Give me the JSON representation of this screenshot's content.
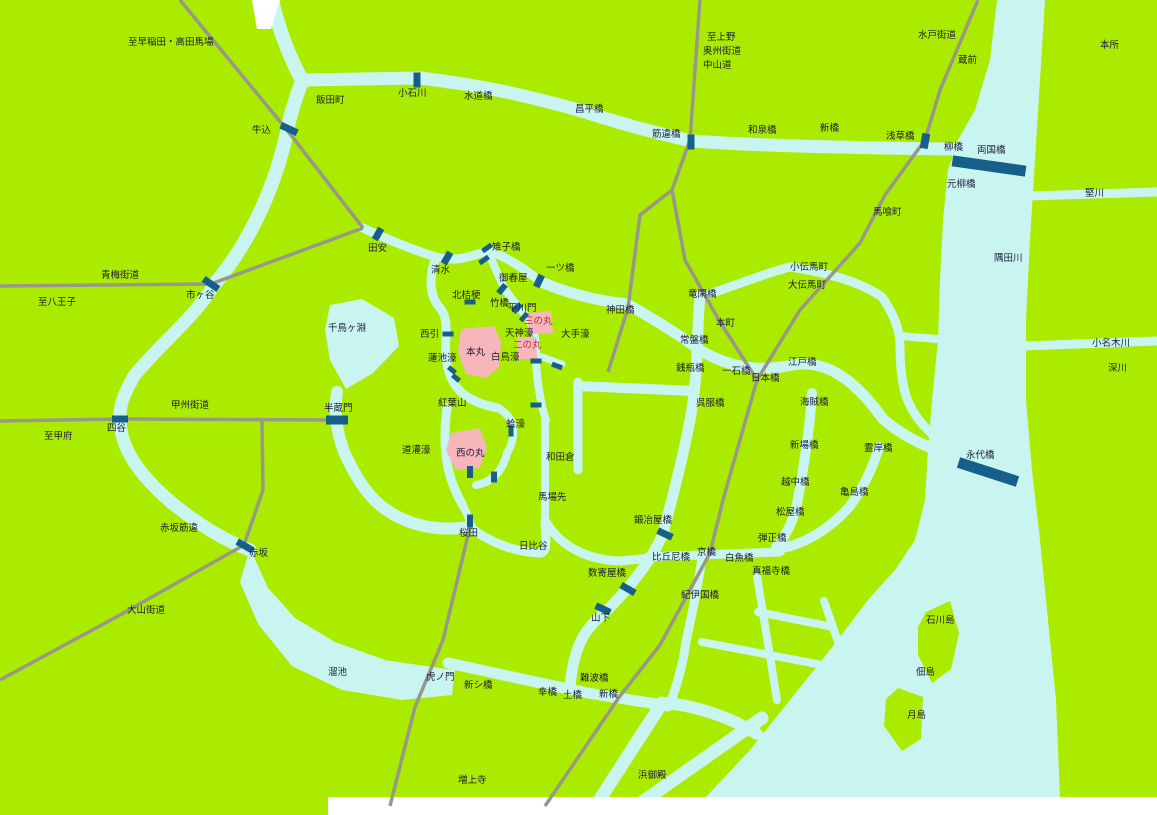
{
  "map": {
    "title": "江戸図 (Map of Edo)",
    "colors": {
      "land": "#abeb00",
      "water": "#c9f5f0",
      "bridge": "#155f8a",
      "road": "#98988a",
      "castle": "#f6b6bc",
      "label": "#1c1c3a",
      "castle_label": "#b03030",
      "edge": "#ffffff"
    },
    "water": {
      "polys": [
        {
          "name": "sumida-river-and-bay",
          "points": "997,0 990,60 975,110 958,140 948,170 943,220 940,280 938,340 932,400 928,450 925,500 915,540 895,570 868,600 830,650 790,700 750,750 706,797 1060,797 1056,700 1048,620 1040,540 1032,470 1026,400 1026,320 1030,240 1035,160 1040,80 1045,0"
        },
        {
          "name": "tameike-pond",
          "points": "250,548 268,588 295,618 335,642 385,660 432,667 455,670 452,695 402,700 342,690 292,666 258,624 240,582"
        },
        {
          "name": "chidorigafuchi-moat",
          "points": "330,305 362,299 394,318 399,346 373,373 346,389 330,360 325,330"
        }
      ],
      "paths": [
        {
          "name": "kanda-river-feeder",
          "d": "M272,0 C280,35 292,62 303,82",
          "w": 14
        },
        {
          "name": "kanda-river",
          "d": "M303,80 L420,78 C480,85 530,96 585,112 C635,128 662,134 691,141 C760,146 860,148 957,149",
          "w": 13
        },
        {
          "name": "ushigome-moat",
          "d": "M300,86 C291,112 288,124 287,132 C272,200 242,252 213,286",
          "w": 14
        },
        {
          "name": "sotobori-west",
          "d": "M213,286 C196,316 158,346 134,376 C123,396 119,406 120,421 C121,448 138,474 172,503 C202,527 226,541 250,550",
          "w": 13
        },
        {
          "name": "sotobori-south",
          "d": "M448,663 C495,673 548,685 588,693 C618,698 645,702 668,706",
          "w": 11
        },
        {
          "name": "shiodome-channel-1",
          "d": "M662,703 L600,799",
          "w": 13
        },
        {
          "name": "shiodome-channel-2",
          "d": "M628,812 L762,718",
          "w": 13
        },
        {
          "name": "shiodome-outlet",
          "d": "M668,703 C700,707 732,718 757,734",
          "w": 12
        },
        {
          "name": "sotobori-east",
          "d": "M700,295 C696,340 699,372 690,420 C682,462 671,503 663,533 C652,562 622,596 603,614 C585,629 574,645 570,686",
          "w": 11
        },
        {
          "name": "nihonbashi-river",
          "d": "M541,282 C570,294 598,301 627,304 C657,321 681,336 698,349 C726,366 756,373 793,365 C833,358 863,391 883,419 C899,433 916,442 934,449",
          "w": 11
        },
        {
          "name": "ryukan-canal",
          "d": "M700,297 C735,286 765,273 790,267 C830,273 862,283 882,297",
          "w": 9
        },
        {
          "name": "hamacho-canal",
          "d": "M882,297 C895,316 900,331 900,346 C900,366 902,383 906,396 C912,413 922,425 934,436",
          "w": 9
        },
        {
          "name": "hamacho-branch",
          "d": "M900,336 L962,341",
          "w": 8
        },
        {
          "name": "kaede-river",
          "d": "M812,393 C810,426 804,466 797,504 C793,521 786,536 776,547",
          "w": 10
        },
        {
          "name": "kyobashi-river",
          "d": "M648,557 L780,552",
          "w": 9
        },
        {
          "name": "sanjukkenbori",
          "d": "M702,557 C699,583 692,613 686,642 C683,663 678,683 670,703",
          "w": 9
        },
        {
          "name": "kamejima-river",
          "d": "M776,549 C802,546 830,529 850,506 C866,484 874,464 879,447",
          "w": 10
        },
        {
          "name": "hatchobori-canal-1",
          "d": "M757,576 L777,700",
          "w": 8
        },
        {
          "name": "hatchobori-canal-2",
          "d": "M702,642 L822,665",
          "w": 8
        },
        {
          "name": "hatchobori-canal-3",
          "d": "M758,612 L833,627",
          "w": 8
        },
        {
          "name": "hatchobori-canal-4",
          "d": "M824,601 L858,700",
          "w": 8
        },
        {
          "name": "tatekawa-canal",
          "d": "M1028,196 L1157,192",
          "w": 9
        },
        {
          "name": "onagigawa-canal",
          "d": "M1024,346 L1157,341",
          "w": 9
        },
        {
          "name": "castle-north-moat",
          "d": "M363,228 C395,243 420,252 436,257 C462,263 473,254 489,251 C509,258 526,270 541,282",
          "w": 9
        },
        {
          "name": "castle-west-moat",
          "d": "M436,257 C427,281 431,299 441,309 C450,322 444,339 446,355 C447,371 452,384 462,393 C473,402 487,406 498,408",
          "w": 9
        },
        {
          "name": "hirakawa-moat",
          "d": "M489,252 C494,268 501,281 506,291 C514,302 521,310 528,318",
          "w": 8
        },
        {
          "name": "tenjin-ote-moat",
          "d": "M528,318 C534,328 536,340 536,352 C536,366 537,378 539,390 C541,402 543,412 546,420",
          "w": 8
        },
        {
          "name": "ote-connector",
          "d": "M536,355 L562,364",
          "w": 7
        },
        {
          "name": "wadakura-moat-west",
          "d": "M545,418 L545,522",
          "w": 8
        },
        {
          "name": "babasaki-moat",
          "d": "M578,382 L578,470",
          "w": 9
        },
        {
          "name": "wadakura-connector",
          "d": "M578,386 L695,391",
          "w": 10
        },
        {
          "name": "sakurada-moat",
          "d": "M337,392 C334,412 336,432 345,454 C358,482 370,498 385,509 C412,528 442,531 470,527",
          "w": 12
        },
        {
          "name": "dokan-moat",
          "d": "M447,408 C444,430 444,452 449,472 C452,484 457,495 463,506",
          "w": 9
        },
        {
          "name": "hibiya-moat-west",
          "d": "M470,527 C490,543 515,552 540,553 C549,552 545,536 545,522",
          "w": 9
        },
        {
          "name": "hibiya-moat-east",
          "d": "M545,520 C560,548 590,560 620,561 L650,558",
          "w": 9
        },
        {
          "name": "hamaguri-moat",
          "d": "M498,408 C507,413 512,420 513,428 C514,438 511,447 507,453",
          "w": 8
        },
        {
          "name": "nishinomaru-south-moat",
          "d": "M507,453 C503,472 490,483 476,485",
          "w": 8
        },
        {
          "name": "nishinomaru-link",
          "d": "M463,506 C468,515 470,521 471,527",
          "w": 8
        }
      ]
    },
    "islands": [
      {
        "name": "ishikawajima-island",
        "points": "926,612 950,601 959,633 951,669 932,683 918,655 918,627"
      },
      {
        "name": "tsukishima-island",
        "points": "898,688 923,697 921,739 902,751 884,726 886,699"
      }
    ],
    "castle": [
      {
        "name": "honmaru-area",
        "points": "461,329 494,326 501,342 499,367 486,378 466,374 458,352"
      },
      {
        "name": "ninomaru-area",
        "points": "517,337 536,337 537,359 518,359"
      },
      {
        "name": "sannomaru-area",
        "points": "527,313 551,311 553,333 529,334"
      },
      {
        "name": "nishinomaru-area",
        "points": "451,433 480,428 487,447 480,468 456,470 446,450"
      }
    ],
    "edges": [
      {
        "name": "map-edge-top-notch",
        "points": "252,0 280,0 271,29 257,29"
      },
      {
        "name": "map-edge-bottom",
        "points": "328,797 1157,797 1157,815 328,815"
      }
    ],
    "roads": [
      {
        "name": "road-to-waseda",
        "points": "180,0 287,130 363,228"
      },
      {
        "name": "road-ome-kaido",
        "points": "0,286 211,284 363,228"
      },
      {
        "name": "road-koshu-kaido",
        "points": "0,421 120,419 336,420"
      },
      {
        "name": "road-akasaka",
        "points": "262,421 263,490 244,545"
      },
      {
        "name": "road-oyama-kaido",
        "points": "244,545 120,615 0,680"
      },
      {
        "name": "road-nakasendo-north",
        "points": "700,0 690,140 672,190"
      },
      {
        "name": "road-kandabashi",
        "points": "672,190 640,215 628,308 608,372"
      },
      {
        "name": "road-tokaido",
        "points": "672,190 685,260 720,322 757,380 723,500 710,553 660,645 620,696 545,806"
      },
      {
        "name": "road-mito-kaido",
        "points": "978,0 940,90 925,140"
      },
      {
        "name": "road-oshu-kaido",
        "points": "925,140 885,195 860,243 800,310 757,380"
      },
      {
        "name": "road-sakurada-south",
        "points": "470,527 443,640 415,707 390,806"
      }
    ],
    "bridges": [
      {
        "name": "ushigome",
        "x": 289,
        "y": 129,
        "w": 18,
        "h": 7,
        "a": 25
      },
      {
        "name": "koishikawa",
        "x": 417,
        "y": 80,
        "w": 7,
        "h": 15,
        "a": 0
      },
      {
        "name": "sujikaibashi",
        "x": 691,
        "y": 142,
        "w": 7,
        "h": 15,
        "a": 0
      },
      {
        "name": "asakusabashi",
        "x": 925,
        "y": 141,
        "w": 8,
        "h": 15,
        "a": 10
      },
      {
        "name": "ryogokubashi",
        "x": 989,
        "y": 166,
        "w": 74,
        "h": 11,
        "a": 8
      },
      {
        "name": "ichigaya",
        "x": 211,
        "y": 284,
        "w": 18,
        "h": 7,
        "a": 35
      },
      {
        "name": "yotsuya",
        "x": 120,
        "y": 419,
        "w": 16,
        "h": 7,
        "a": 0
      },
      {
        "name": "hanzomon",
        "x": 337,
        "y": 420,
        "w": 22,
        "h": 9,
        "a": 0
      },
      {
        "name": "akasaka",
        "x": 245,
        "y": 546,
        "w": 18,
        "h": 7,
        "a": 30
      },
      {
        "name": "tayasu",
        "x": 378,
        "y": 234,
        "w": 7,
        "h": 13,
        "a": 30
      },
      {
        "name": "shimizu",
        "x": 447,
        "y": 258,
        "w": 7,
        "h": 13,
        "a": 30
      },
      {
        "name": "kijibashi-1",
        "x": 487,
        "y": 248,
        "w": 5,
        "h": 11,
        "a": 55
      },
      {
        "name": "kijibashi-2",
        "x": 484,
        "y": 260,
        "w": 5,
        "h": 11,
        "a": 55
      },
      {
        "name": "hitotsubashi",
        "x": 539,
        "y": 281,
        "w": 7,
        "h": 13,
        "a": 25
      },
      {
        "name": "kitahanebashi",
        "x": 470,
        "y": 302,
        "w": 11,
        "h": 5,
        "a": 0
      },
      {
        "name": "takebashi",
        "x": 502,
        "y": 289,
        "w": 6,
        "h": 11,
        "a": 40
      },
      {
        "name": "hirakawamon",
        "x": 517,
        "y": 308,
        "w": 6,
        "h": 11,
        "a": 45
      },
      {
        "name": "sannomaru",
        "x": 524,
        "y": 317,
        "w": 5,
        "h": 10,
        "a": 40
      },
      {
        "name": "nishibiki",
        "x": 448,
        "y": 334,
        "w": 11,
        "h": 5,
        "a": 0
      },
      {
        "name": "hasuike-1",
        "x": 452,
        "y": 370,
        "w": 9,
        "h": 5,
        "a": 40
      },
      {
        "name": "hasuike-2",
        "x": 456,
        "y": 378,
        "w": 9,
        "h": 5,
        "a": 40
      },
      {
        "name": "ote-1",
        "x": 536,
        "y": 361,
        "w": 11,
        "h": 5,
        "a": 0
      },
      {
        "name": "ote-2",
        "x": 557,
        "y": 366,
        "w": 11,
        "h": 5,
        "a": 20
      },
      {
        "name": "ote-3",
        "x": 536,
        "y": 405,
        "w": 11,
        "h": 5,
        "a": 0
      },
      {
        "name": "hamaguri",
        "x": 511,
        "y": 431,
        "w": 5,
        "h": 11,
        "a": 0
      },
      {
        "name": "nishinomaru-1",
        "x": 470,
        "y": 472,
        "w": 6,
        "h": 12,
        "a": 0
      },
      {
        "name": "nishinomaru-2",
        "x": 494,
        "y": 477,
        "w": 6,
        "h": 11,
        "a": 0
      },
      {
        "name": "sakurada",
        "x": 470,
        "y": 521,
        "w": 6,
        "h": 13,
        "a": 0
      },
      {
        "name": "kajiyabashi",
        "x": 665,
        "y": 534,
        "w": 16,
        "h": 7,
        "a": 25
      },
      {
        "name": "sukiyabashi",
        "x": 628,
        "y": 589,
        "w": 16,
        "h": 7,
        "a": 30
      },
      {
        "name": "yamashita",
        "x": 603,
        "y": 609,
        "w": 16,
        "h": 7,
        "a": 25
      },
      {
        "name": "eitaibashi",
        "x": 988,
        "y": 472,
        "w": 62,
        "h": 11,
        "a": 18
      }
    ],
    "labels": [
      {
        "t": "至早稲田・高田馬場",
        "x": 128,
        "y": 45
      },
      {
        "t": "飯田町",
        "x": 316,
        "y": 103
      },
      {
        "t": "牛込",
        "x": 252,
        "y": 133
      },
      {
        "t": "小石川",
        "x": 398,
        "y": 96
      },
      {
        "t": "水道橋",
        "x": 464,
        "y": 99
      },
      {
        "t": "昌平橋",
        "x": 575,
        "y": 112
      },
      {
        "t": "筋違橋",
        "x": 652,
        "y": 137
      },
      {
        "t": "至上野",
        "x": 707,
        "y": 40
      },
      {
        "t": "奥州街道",
        "x": 703,
        "y": 54
      },
      {
        "t": "中山道",
        "x": 703,
        "y": 68
      },
      {
        "t": "水戸街道",
        "x": 918,
        "y": 38
      },
      {
        "t": "蔵前",
        "x": 958,
        "y": 63
      },
      {
        "t": "和泉橋",
        "x": 748,
        "y": 133
      },
      {
        "t": "新橋",
        "x": 820,
        "y": 131
      },
      {
        "t": "浅草橋",
        "x": 886,
        "y": 139
      },
      {
        "t": "柳橋",
        "x": 944,
        "y": 150
      },
      {
        "t": "両国橋",
        "x": 977,
        "y": 153
      },
      {
        "t": "元柳橋",
        "x": 947,
        "y": 187
      },
      {
        "t": "本所",
        "x": 1100,
        "y": 48
      },
      {
        "t": "堅川",
        "x": 1085,
        "y": 196
      },
      {
        "t": "馬喰町",
        "x": 873,
        "y": 215
      },
      {
        "t": "隅田川",
        "x": 994,
        "y": 261
      },
      {
        "t": "小名木川",
        "x": 1092,
        "y": 346
      },
      {
        "t": "深川",
        "x": 1108,
        "y": 371
      },
      {
        "t": "青梅街道",
        "x": 101,
        "y": 278
      },
      {
        "t": "至八王子",
        "x": 38,
        "y": 305
      },
      {
        "t": "市ヶ谷",
        "x": 186,
        "y": 298
      },
      {
        "t": "田安",
        "x": 368,
        "y": 251
      },
      {
        "t": "清水",
        "x": 431,
        "y": 273
      },
      {
        "t": "雉子橋",
        "x": 492,
        "y": 250
      },
      {
        "t": "御春屋",
        "x": 499,
        "y": 281
      },
      {
        "t": "一ツ橋",
        "x": 546,
        "y": 271
      },
      {
        "t": "北桔梗",
        "x": 452,
        "y": 298
      },
      {
        "t": "竹橋",
        "x": 490,
        "y": 306
      },
      {
        "t": "平川門",
        "x": 508,
        "y": 311
      },
      {
        "t": "三の丸",
        "x": 524,
        "y": 324,
        "c": "red"
      },
      {
        "t": "天神濠",
        "x": 505,
        "y": 336
      },
      {
        "t": "二の丸",
        "x": 513,
        "y": 348,
        "c": "red"
      },
      {
        "t": "大手濠",
        "x": 561,
        "y": 337
      },
      {
        "t": "西引",
        "x": 420,
        "y": 337
      },
      {
        "t": "本丸",
        "x": 466,
        "y": 355
      },
      {
        "t": "白鳥濠",
        "x": 491,
        "y": 360
      },
      {
        "t": "蓮池濠",
        "x": 428,
        "y": 361
      },
      {
        "t": "千鳥ヶ淵",
        "x": 328,
        "y": 331
      },
      {
        "t": "紅葉山",
        "x": 438,
        "y": 406
      },
      {
        "t": "半蔵門",
        "x": 324,
        "y": 411
      },
      {
        "t": "甲州街道",
        "x": 171,
        "y": 408
      },
      {
        "t": "四谷",
        "x": 107,
        "y": 431
      },
      {
        "t": "至甲府",
        "x": 44,
        "y": 439
      },
      {
        "t": "道灌濠",
        "x": 402,
        "y": 453
      },
      {
        "t": "西の丸",
        "x": 456,
        "y": 456
      },
      {
        "t": "蛤濠",
        "x": 506,
        "y": 427
      },
      {
        "t": "和田倉",
        "x": 546,
        "y": 460
      },
      {
        "t": "馬場先",
        "x": 538,
        "y": 500
      },
      {
        "t": "桜田",
        "x": 459,
        "y": 536
      },
      {
        "t": "日比谷",
        "x": 519,
        "y": 549
      },
      {
        "t": "神田橋",
        "x": 606,
        "y": 313
      },
      {
        "t": "竜閑橋",
        "x": 688,
        "y": 297
      },
      {
        "t": "小伝馬町",
        "x": 790,
        "y": 270
      },
      {
        "t": "大伝馬町",
        "x": 788,
        "y": 288
      },
      {
        "t": "本町",
        "x": 716,
        "y": 326
      },
      {
        "t": "常盤橋",
        "x": 680,
        "y": 343
      },
      {
        "t": "銭瓶橋",
        "x": 676,
        "y": 371
      },
      {
        "t": "一石橋",
        "x": 722,
        "y": 374
      },
      {
        "t": "日本橋",
        "x": 751,
        "y": 381
      },
      {
        "t": "江戸橋",
        "x": 788,
        "y": 365
      },
      {
        "t": "呉服橋",
        "x": 696,
        "y": 406
      },
      {
        "t": "海賊橋",
        "x": 800,
        "y": 405
      },
      {
        "t": "新場橋",
        "x": 790,
        "y": 448
      },
      {
        "t": "霊岸橋",
        "x": 864,
        "y": 451
      },
      {
        "t": "越中橋",
        "x": 781,
        "y": 485
      },
      {
        "t": "亀島橋",
        "x": 840,
        "y": 495
      },
      {
        "t": "松屋橋",
        "x": 776,
        "y": 515
      },
      {
        "t": "弾正橋",
        "x": 758,
        "y": 541
      },
      {
        "t": "白魚橋",
        "x": 725,
        "y": 561
      },
      {
        "t": "真福寺橋",
        "x": 752,
        "y": 574
      },
      {
        "t": "京橋",
        "x": 697,
        "y": 555
      },
      {
        "t": "比丘尼橋",
        "x": 652,
        "y": 560
      },
      {
        "t": "鍛冶屋橋",
        "x": 634,
        "y": 523
      },
      {
        "t": "数寄屋橋",
        "x": 588,
        "y": 576
      },
      {
        "t": "紀伊国橋",
        "x": 681,
        "y": 598
      },
      {
        "t": "山下",
        "x": 591,
        "y": 621
      },
      {
        "t": "永代橋",
        "x": 966,
        "y": 458
      },
      {
        "t": "石川島",
        "x": 926,
        "y": 623
      },
      {
        "t": "佃島",
        "x": 916,
        "y": 675
      },
      {
        "t": "月島",
        "x": 907,
        "y": 718
      },
      {
        "t": "赤坂筋違",
        "x": 160,
        "y": 531
      },
      {
        "t": "赤坂",
        "x": 249,
        "y": 556
      },
      {
        "t": "大山街道",
        "x": 127,
        "y": 613
      },
      {
        "t": "溜池",
        "x": 328,
        "y": 675
      },
      {
        "t": "虎ノ門",
        "x": 426,
        "y": 680
      },
      {
        "t": "新シ橋",
        "x": 464,
        "y": 688
      },
      {
        "t": "幸橋",
        "x": 538,
        "y": 695
      },
      {
        "t": "土橋",
        "x": 563,
        "y": 698
      },
      {
        "t": "難波橋",
        "x": 580,
        "y": 681
      },
      {
        "t": "新橋",
        "x": 599,
        "y": 697
      },
      {
        "t": "増上寺",
        "x": 458,
        "y": 783
      },
      {
        "t": "浜御殿",
        "x": 638,
        "y": 778
      }
    ]
  }
}
